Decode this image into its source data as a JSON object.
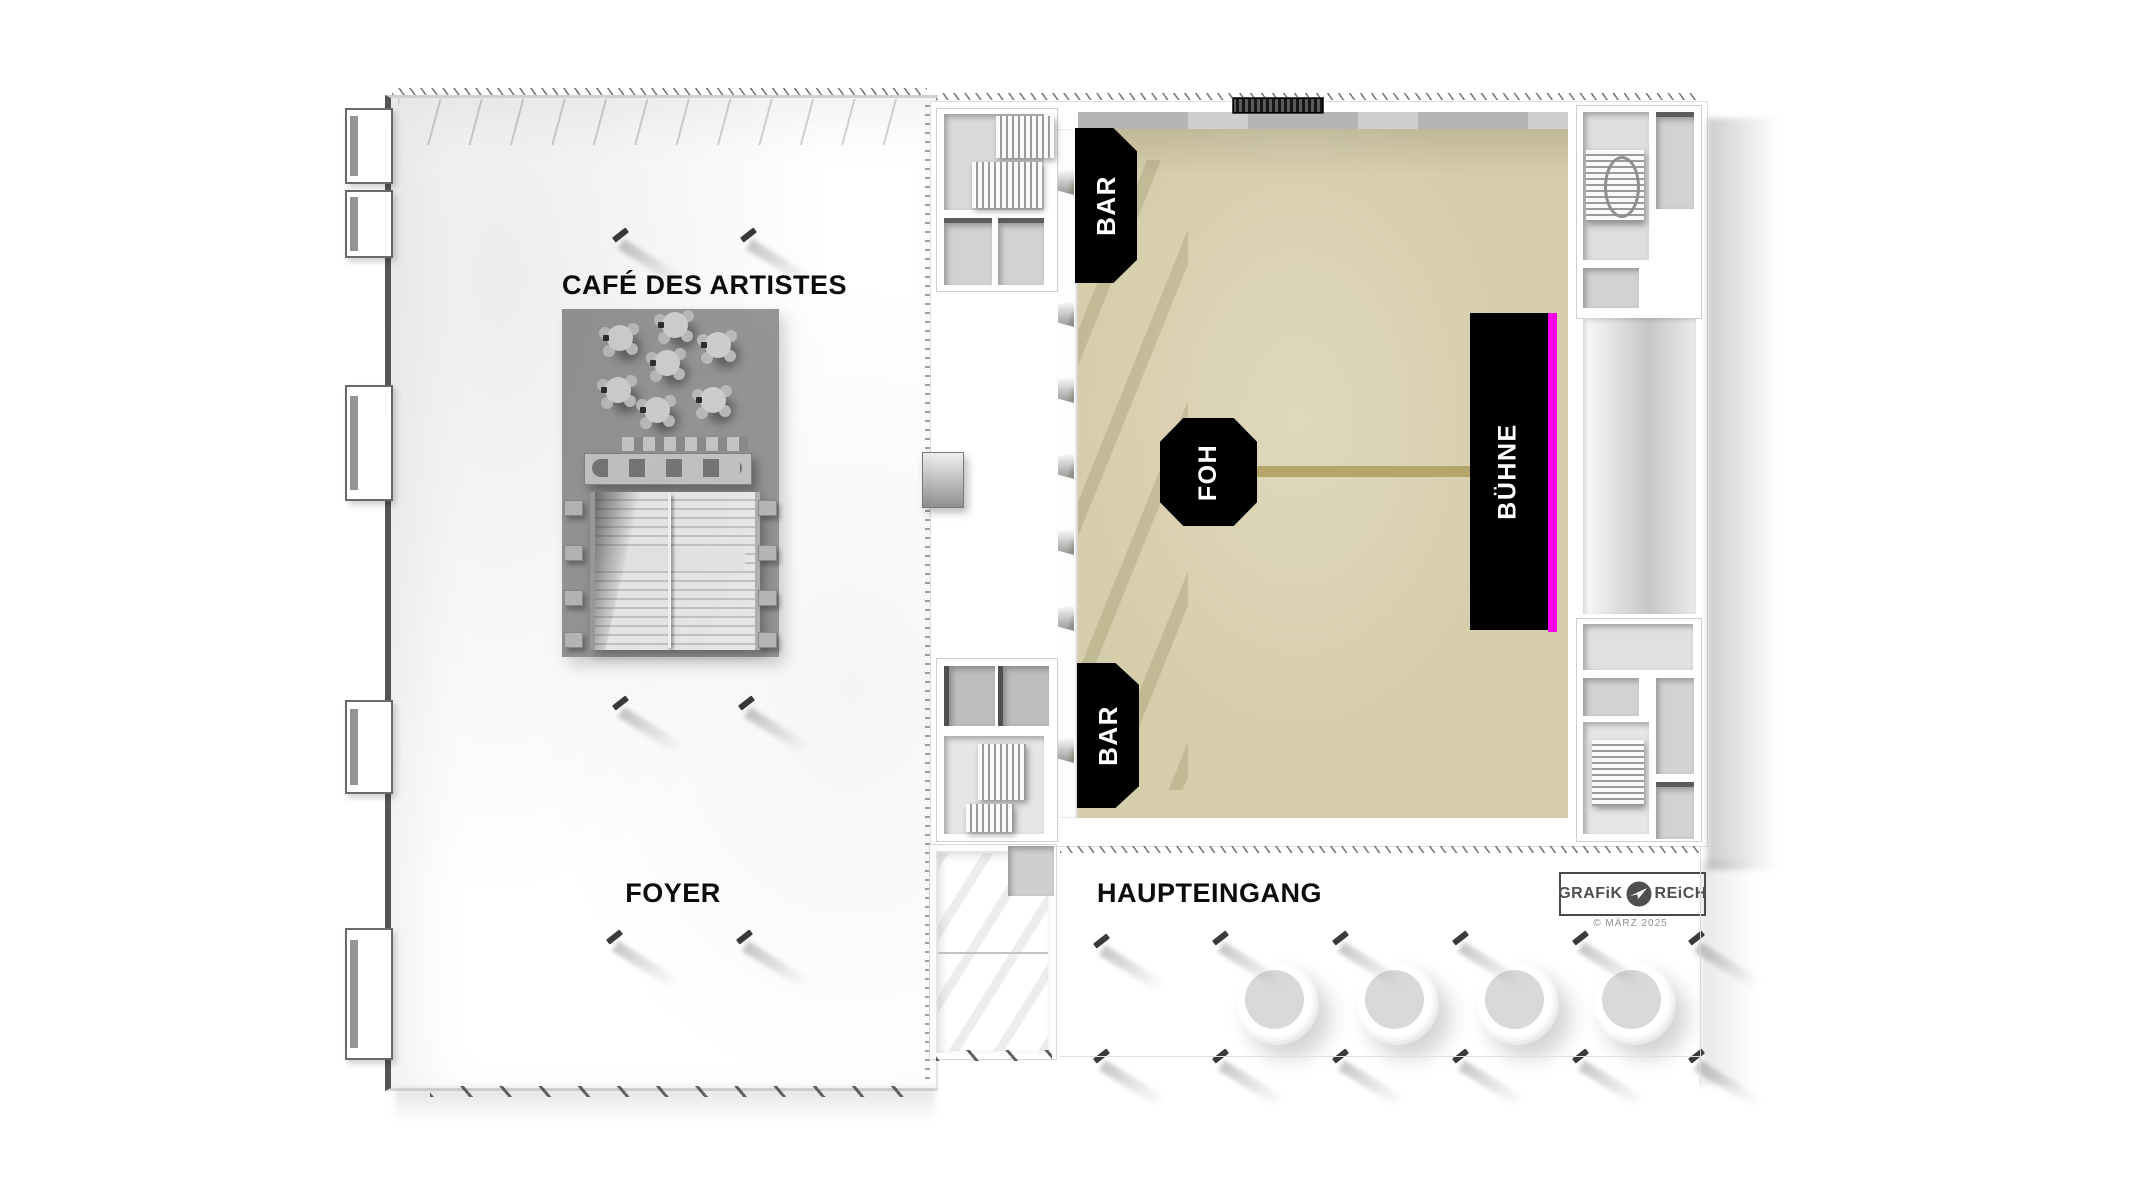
{
  "title": "Veranstaltungshalle Grundriss",
  "areas": {
    "cafe_label": "CAFÉ DES ARTISTES",
    "foyer_label": "FOYER",
    "entrance_label": "HAUPTEINGANG",
    "bar_top_label": "BAR",
    "bar_bottom_label": "BAR",
    "foh_label": "FOH",
    "stage_label": "BÜHNE"
  },
  "branding": {
    "logo_left": "GRAFiK",
    "logo_right": "REiCH",
    "copyright": "© MÄRZ 2025"
  },
  "colors": {
    "hall_floor": "#d6cdaa",
    "foh_stage_line": "#b4a56b",
    "stage_front_accent": "#ff00ee",
    "label_background": "#000000",
    "label_text": "#ffffff",
    "cafe_floor": "#979797"
  }
}
